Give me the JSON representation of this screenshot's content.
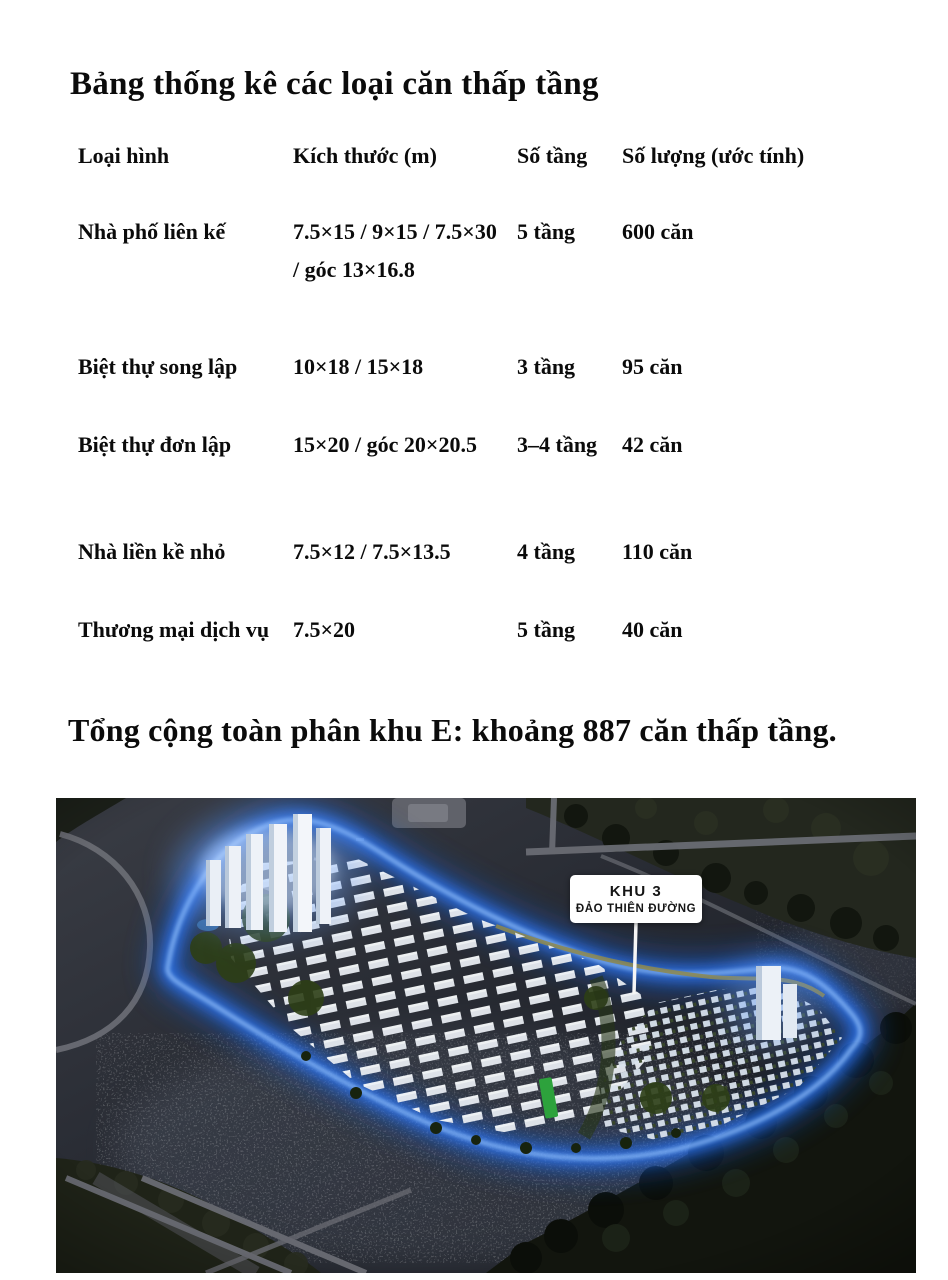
{
  "page": {
    "title": "Bảng thống kê các loại căn thấp tầng",
    "summary": "Tổng cộng toàn phân khu E: khoảng 887 căn thấp tầng."
  },
  "table": {
    "columns": [
      "Loại hình",
      "Kích thước (m)",
      "Số tầng",
      "Số lượng (ước tính)"
    ],
    "rows": [
      {
        "type": "Nhà phố liên kế",
        "size": "7.5×15 / 9×15 / 7.5×30 / góc 13×16.8",
        "floors": "5 tầng",
        "count": "600 căn"
      },
      {
        "type": "Biệt thự song lập",
        "size": "10×18 / 15×18",
        "floors": "3 tầng",
        "count": "95 căn"
      },
      {
        "type": "Biệt thự đơn lập",
        "size": "15×20 / góc 20×20.5",
        "floors": "3–4 tầng",
        "count": "42 căn"
      },
      {
        "type": "Nhà liền kề nhỏ",
        "size": "7.5×12 / 7.5×13.5",
        "floors": "4 tầng",
        "count": "110 căn"
      },
      {
        "type": "Thương mại dịch vụ",
        "size": "7.5×20",
        "floors": "5 tầng",
        "count": "40 căn"
      }
    ]
  },
  "map": {
    "label_line1": "KHU 3",
    "label_line2": "ĐẢO THIÊN ĐƯỜNG"
  },
  "colors": {
    "island_glow": "#2f7dff",
    "label_background": "#ffffff",
    "text": "#0b0b0b"
  }
}
